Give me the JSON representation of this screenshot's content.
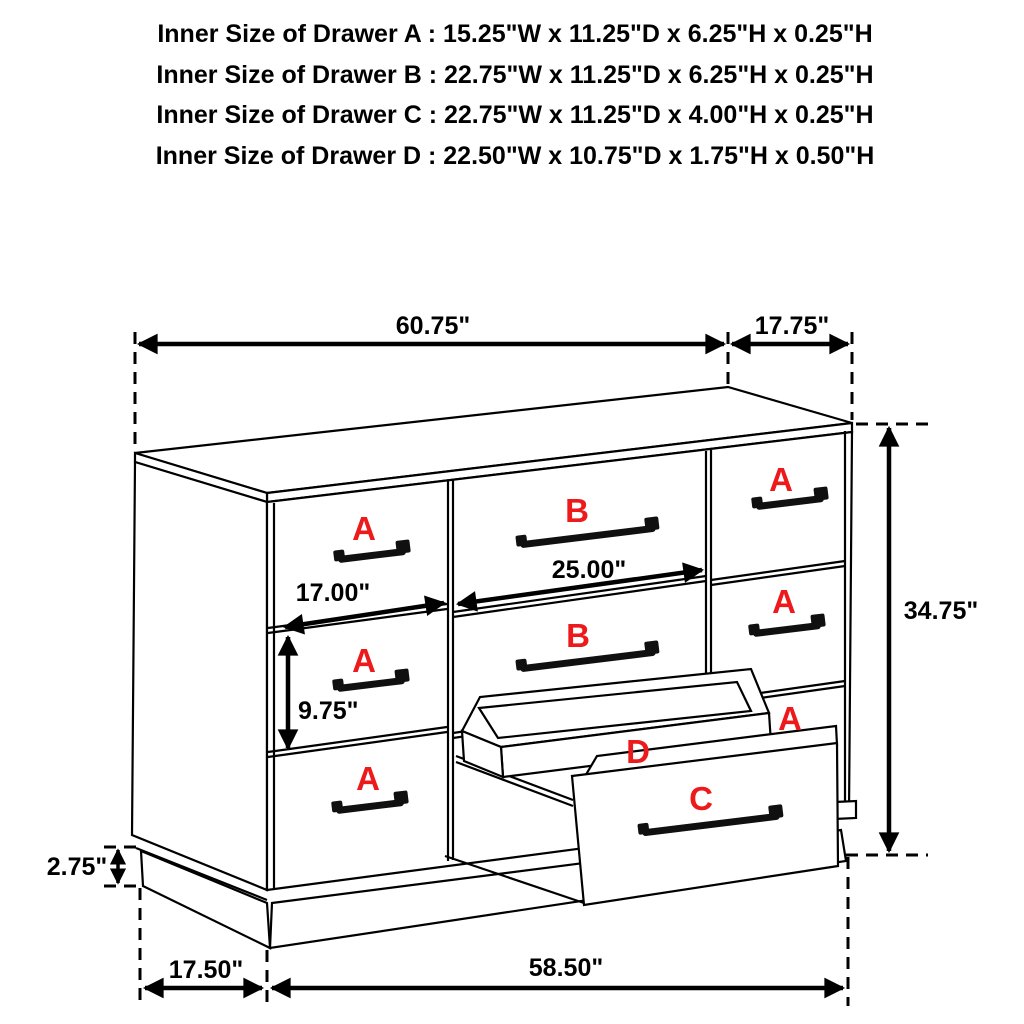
{
  "title": {
    "lines": [
      "Inner Size of Drawer A : 15.25\"W x 11.25\"D x 6.25\"H x 0.25\"H",
      "Inner Size of Drawer B : 22.75\"W x 11.25\"D x 6.25\"H x 0.25\"H",
      "Inner Size of Drawer C : 22.75\"W x 11.25\"D x 4.00\"H x 0.25\"H",
      "Inner Size of Drawer D : 22.50\"W x 10.75\"D x 1.75\"H x 0.50\"H"
    ]
  },
  "dimensions": {
    "top_width": "60.75\"",
    "top_depth": "17.75\"",
    "overall_height": "34.75\"",
    "middle_drawer_width": "25.00\"",
    "left_drawer_width": "17.00\"",
    "drawer_front_height": "9.75\"",
    "base_height": "2.75\"",
    "base_side_depth": "17.50\"",
    "base_front_width": "58.50\""
  },
  "drawer_labels": {
    "left_top": "A",
    "left_middle": "A",
    "left_bottom": "A",
    "middle_top": "B",
    "middle_second": "B",
    "right_top": "A",
    "right_middle": "A",
    "right_bottom": "A",
    "open_drawer": "C",
    "open_tray": "D"
  },
  "colors": {
    "label": "#ed1a1c",
    "line": "#000000"
  }
}
